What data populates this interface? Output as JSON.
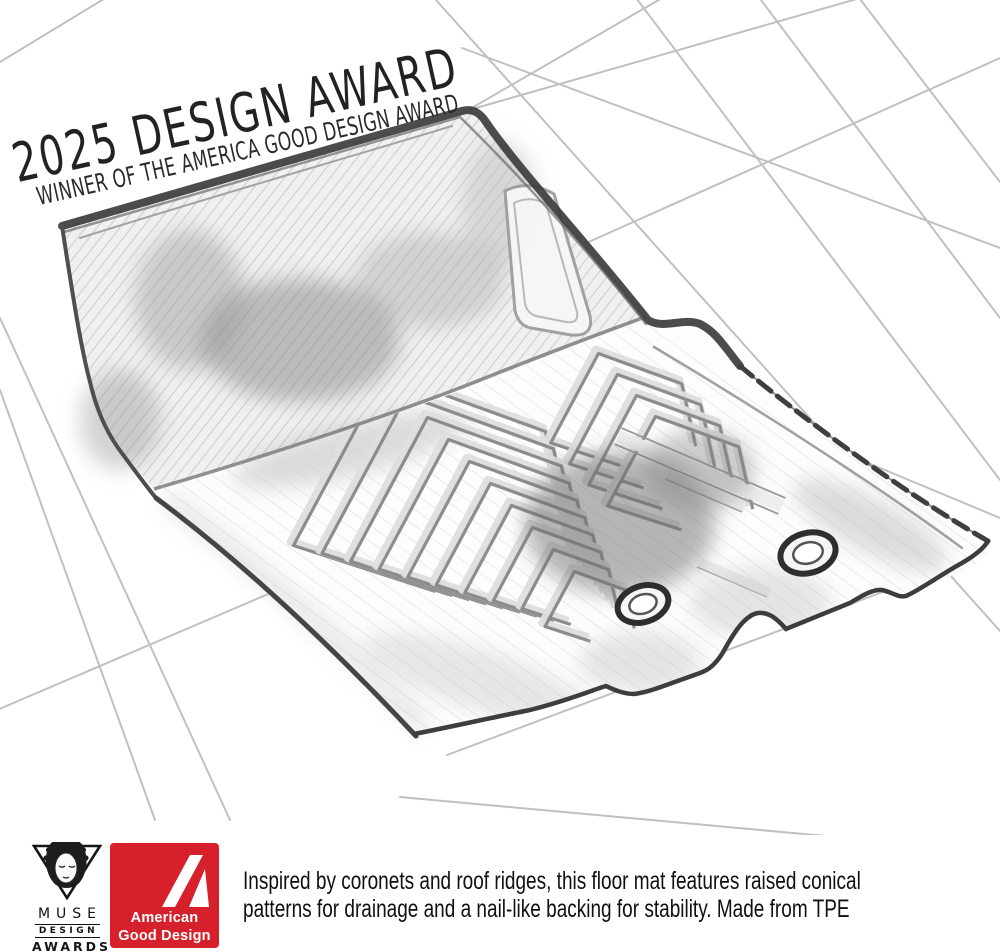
{
  "award_banner": {
    "title": "2025 DESIGN AWARD",
    "subtitle": "WINNER OF THE AMERICA GOOD DESIGN AWARD"
  },
  "sketch": {
    "subject": "pencil sketch of a vehicle floor mat with raised chevron ridge pattern, two grommet holes and a heel pad panel on a perspective tile grid",
    "pencil_color": "#3a3a3a",
    "grid_color": "#b6b6b6"
  },
  "footer": {
    "muse_logo": {
      "line1": "MUSE",
      "line2": "DESIGN",
      "line3": "AWARDS"
    },
    "agd_logo": {
      "line1": "American",
      "line2": "Good Design",
      "color": "#d6202c"
    },
    "tagline_line1": "Inspired by coronets and roof ridges, this floor mat features raised conical",
    "tagline_line2": "patterns for drainage and a nail-like backing for stability. Made from TPE"
  }
}
